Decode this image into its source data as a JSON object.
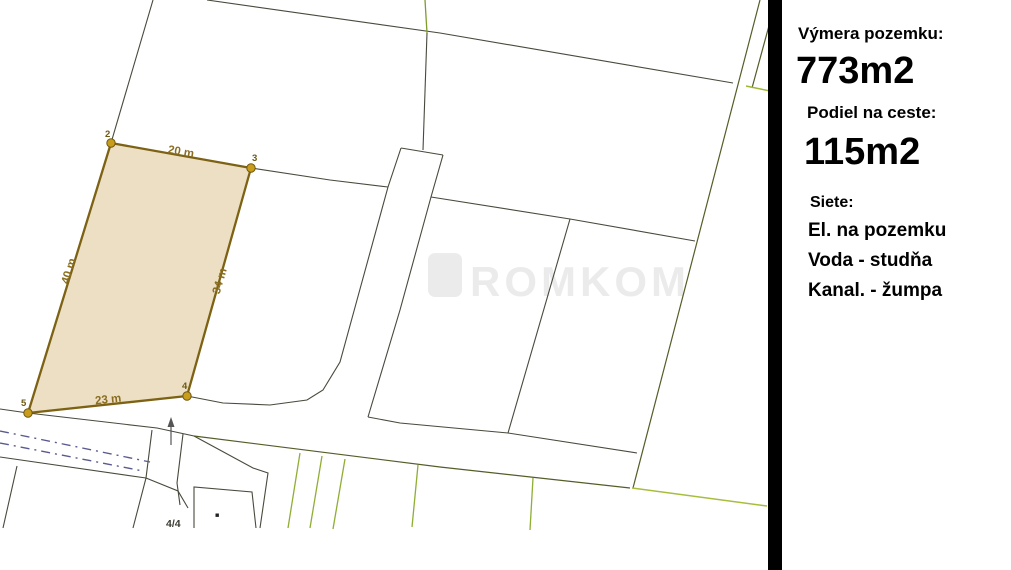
{
  "panel": {
    "area_label": "Výmera pozemku:",
    "area_value": "773m2",
    "road_share_label": "Podiel na ceste:",
    "road_share_value": "115m2",
    "utilities_label": "Siete:",
    "utilities": [
      "El. na pozemku",
      "Voda - studňa",
      "Kanal. - žumpa"
    ]
  },
  "map": {
    "plot": {
      "vertex_labels": [
        "2",
        "3",
        "4",
        "5"
      ],
      "dimensions": {
        "top": "20 m",
        "right": "34 m",
        "left": "40 m",
        "bottom": "23 m"
      }
    },
    "parcel_number": "4/4",
    "watermark": "ROMKOM"
  },
  "colors": {
    "plot_fill": "#ecdfc3",
    "plot_border": "#7d6214",
    "vertex_dot": "#c89d1b",
    "boundary_dark": "#474a3c",
    "boundary_olive": "#565c28",
    "boundary_bright_green": "#a6be3c",
    "fence_green": "#8fae33",
    "road_axis_blue": "#5a5a8f",
    "divider": "#000000"
  }
}
